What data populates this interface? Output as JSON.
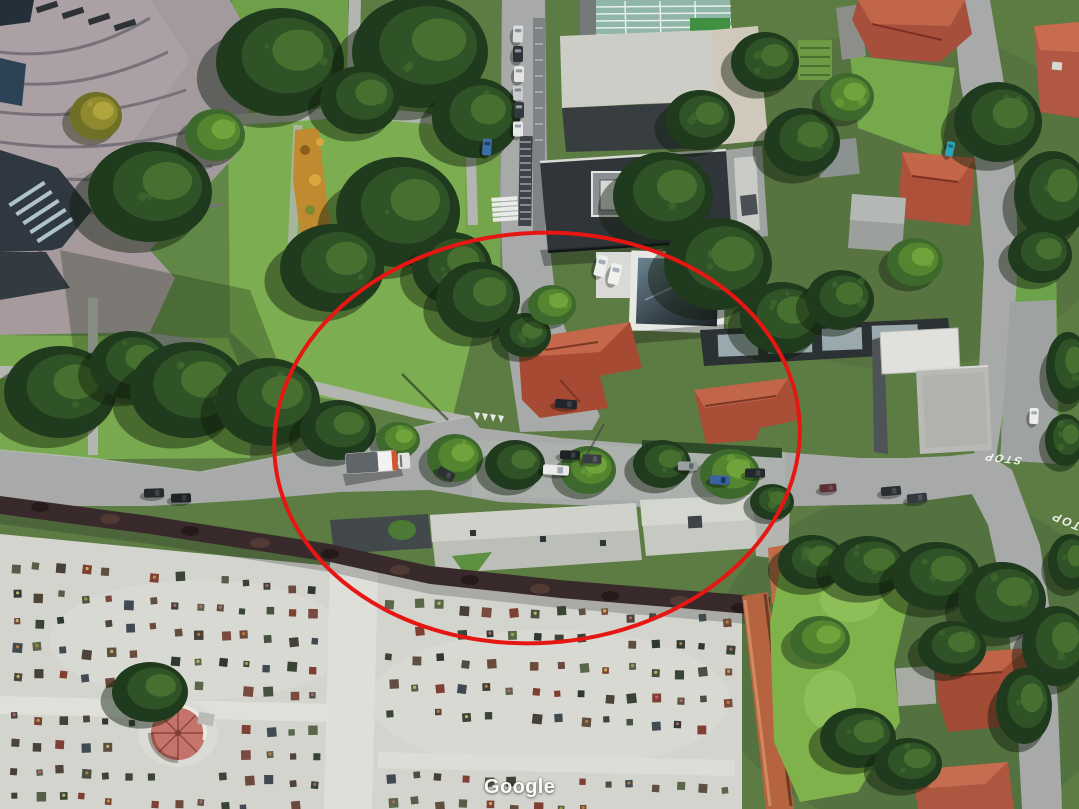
{
  "map": {
    "view_type": "satellite-aerial",
    "watermark": "Google",
    "road_markings": [
      {
        "label": "STOP"
      },
      {
        "label": "STOP"
      }
    ]
  },
  "annotation": {
    "shape": "ellipse",
    "color": "#e61712",
    "stroke_width": 4,
    "center_x": 537,
    "center_y": 438,
    "radius_x": 263,
    "radius_y": 205,
    "rotation_deg": -4
  }
}
